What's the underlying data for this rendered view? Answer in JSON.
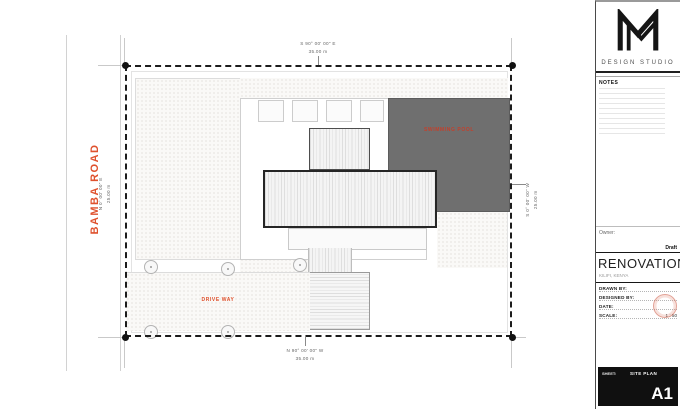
{
  "colors": {
    "accent_red": "#df512d",
    "pool_gray": "#6f6f6f",
    "boundary_dark": "#1c1c1c"
  },
  "road": {
    "name": "BAMBA ROAD",
    "bearing": "N 0° 00' 00\" E",
    "distance": "25.00 m"
  },
  "boundary": {
    "top": {
      "bearing": "S 90° 00' 00\" E",
      "distance": "35.00 m"
    },
    "bottom": {
      "bearing": "N 90° 00' 00\" W",
      "distance": "35.00 m"
    },
    "right": {
      "bearing": "S 0° 00' 00\" W",
      "distance": "25.00 m"
    }
  },
  "plan": {
    "pool_label": "SWIMMING POOL",
    "driveway_label": "DRIVE WAY"
  },
  "title_block": {
    "studio_name": "DESIGN STUDIO",
    "notes_label": "NOTES",
    "owner_label": "Owner:",
    "draft_label": "Draft",
    "project_title": "RENOVATION",
    "project_location": "KILIFI, KENYA",
    "fields": [
      {
        "label": "DRAWN BY:",
        "value": ""
      },
      {
        "label": "DESIGNED BY:",
        "value": ""
      },
      {
        "label": "DATE:",
        "value": ""
      },
      {
        "label": "SCALE:",
        "value": "1 : 50"
      }
    ],
    "sheet": {
      "label": "SHEET:",
      "name": "SITE PLAN",
      "number": "A1"
    }
  }
}
